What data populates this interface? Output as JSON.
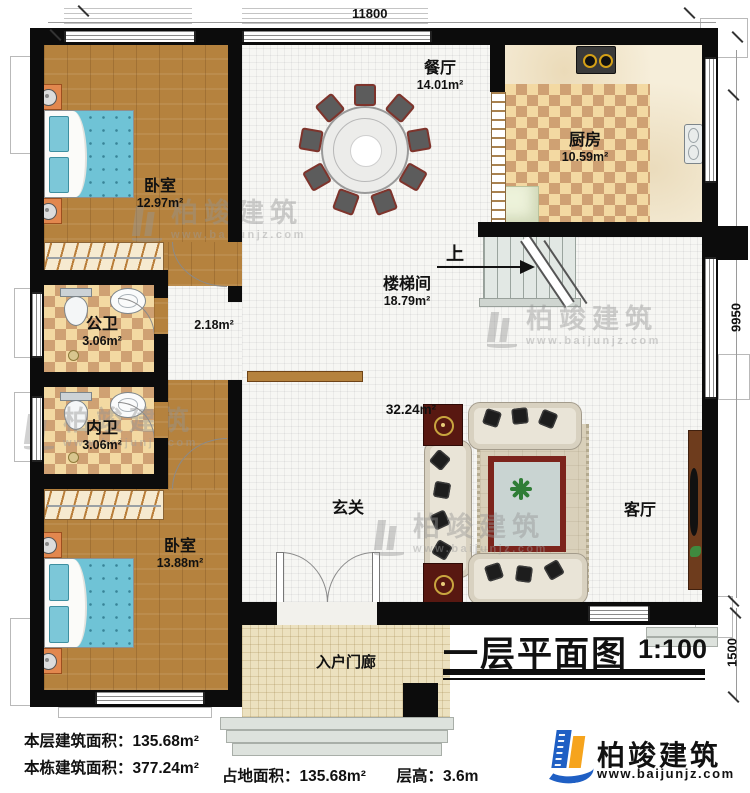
{
  "plan": {
    "title": "一层平面图",
    "scale": "1:100",
    "up": "上",
    "dims": {
      "top": "11800",
      "right": "9950",
      "right_lower": "1500"
    }
  },
  "rooms": {
    "bedroom_top": {
      "name": "卧室",
      "area": "12.97m²"
    },
    "dining": {
      "name": "餐厅",
      "area": "14.01m²"
    },
    "kitchen": {
      "name": "厨房",
      "area": "10.59m²"
    },
    "stairwell": {
      "name": "楼梯间",
      "area": "18.79m²"
    },
    "public_bath": {
      "name": "公卫",
      "area": "3.06m²"
    },
    "inner_bath": {
      "name": "内卫",
      "area": "3.06m²"
    },
    "bedroom_bottom": {
      "name": "卧室",
      "area": "13.88m²"
    },
    "hall": {
      "name": "玄关",
      "area": "32.24m²"
    },
    "living": {
      "name": "客厅"
    },
    "porch": {
      "name": "入户门廊"
    },
    "nook_area": "2.18m²"
  },
  "stats": {
    "floor_area_label": "本层建筑面积：",
    "floor_area_value": "135.68m²",
    "total_area_label": "本栋建筑面积：",
    "total_area_value": "377.24m²",
    "footprint_label": "占地面积：",
    "footprint_value": "135.68m²",
    "height_label": "层高：",
    "height_value": "3.6m"
  },
  "branding": {
    "name": "柏竣建筑",
    "url": "www.baijunjz.com"
  },
  "colors": {
    "wall": "#0c0c0c",
    "wood": "#b5823e",
    "brand_blue": "#1f5fc4",
    "brand_orange": "#f6a41d"
  }
}
